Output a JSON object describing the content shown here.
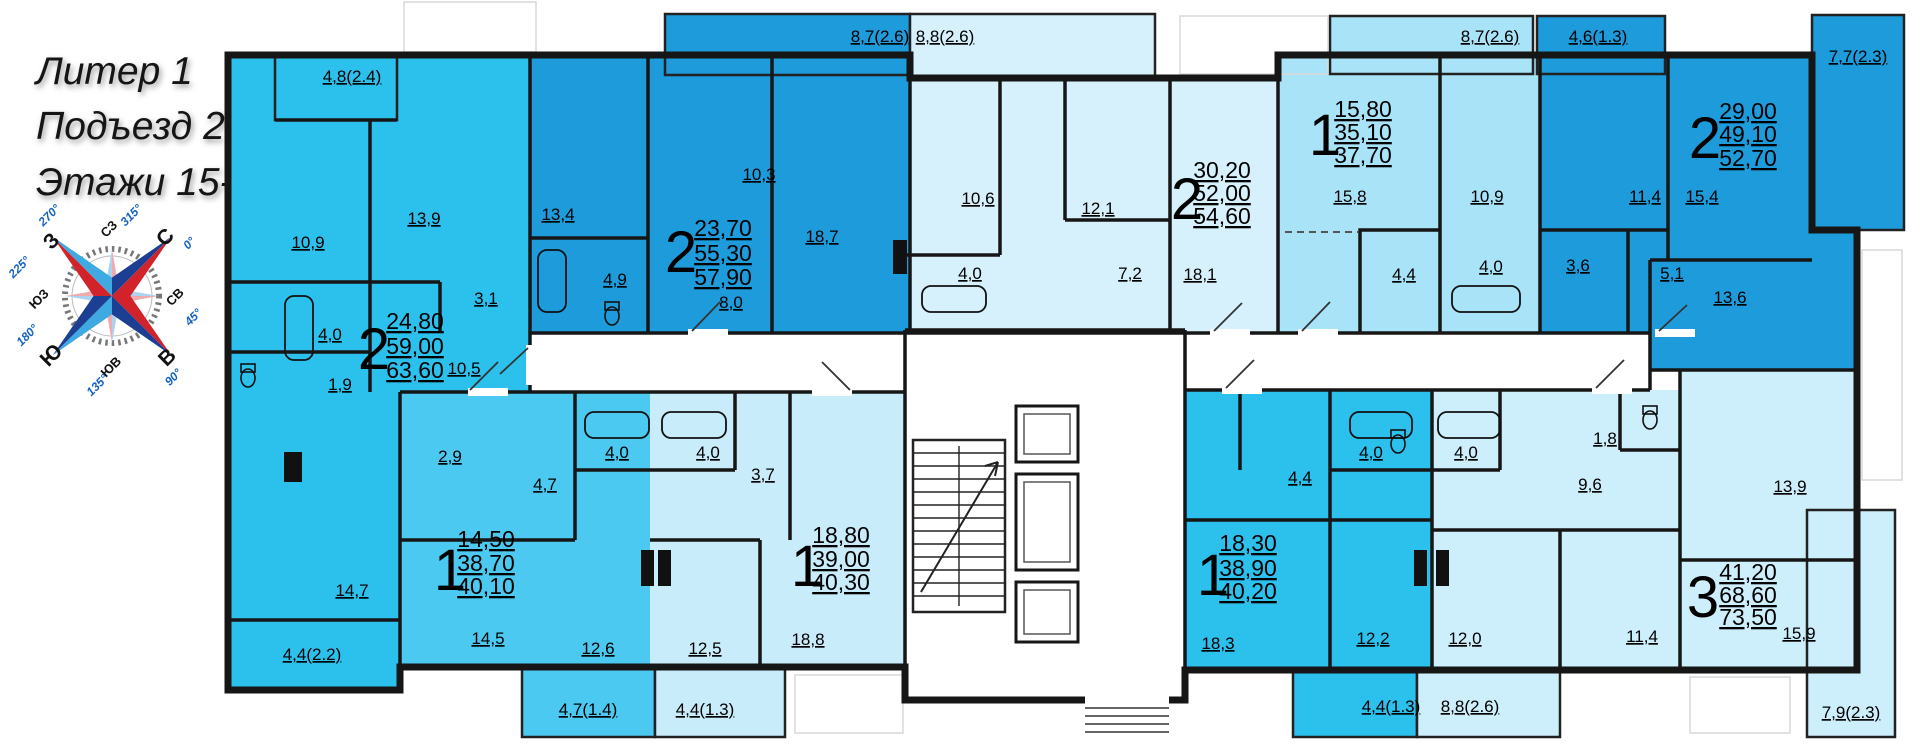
{
  "title": {
    "line1": "Литер 1",
    "line2": "Подъезд 2",
    "line3": "Этажи 15-23"
  },
  "compass": {
    "cardinals": [
      {
        "label": "С",
        "degree": "0°"
      },
      {
        "label": "СВ",
        "degree": "45°"
      },
      {
        "label": "В",
        "degree": "90°"
      },
      {
        "label": "ЮВ",
        "degree": "135°"
      },
      {
        "label": "Ю",
        "degree": "180°"
      },
      {
        "label": "ЮЗ",
        "degree": "225°"
      },
      {
        "label": "З",
        "degree": "270°"
      },
      {
        "label": "СЗ",
        "degree": "315°"
      }
    ]
  },
  "colors": {
    "wall": "#161616",
    "corridor": "#ffffff"
  },
  "apartments": [
    {
      "number_label": "2",
      "area_living": "24,80",
      "area_total": "59,00",
      "area_full": "63,60",
      "color": "#2cc0ed",
      "rooms": {
        "kitchen": "10,9",
        "bedroom": "13,9",
        "bath": "4,0",
        "wc": "1,9",
        "corridor": "3,1",
        "hall": "10,5",
        "living": "14,7"
      },
      "balconies": {
        "top": "4,8(2.4)",
        "bottom": "4,4(2.2)"
      }
    },
    {
      "number_label": "2",
      "area_living": "23,70",
      "area_total": "55,30",
      "area_full": "57,90",
      "color": "#1d9bdb",
      "rooms": {
        "bedroom1": "13,4",
        "bedroom2": "10,3",
        "kitchen_living": "18,7",
        "bath": "4,9",
        "hall": "8,0"
      },
      "balconies": {
        "top": "8,7(2.6)"
      }
    },
    {
      "number_label": "1",
      "area_living": "14,50",
      "area_total": "38,70",
      "area_full": "40,10",
      "color": "#4cc9f0",
      "rooms": {
        "corridor": "2,9",
        "hall": "4,7",
        "bath": "4,0",
        "living": "14,5",
        "kitchen": "12,6"
      },
      "balconies": {
        "bottom": "4,7(1.4)"
      }
    },
    {
      "number_label": "1",
      "area_living": "18,80",
      "area_total": "39,00",
      "area_full": "40,30",
      "color": "#c8ecfa",
      "rooms": {
        "hall": "3,7",
        "bath": "4,0",
        "bedroom": "12,5",
        "living": "18,8"
      },
      "balconies": {
        "bottom": "4,4(1.3)"
      }
    },
    {
      "number_label": "2",
      "area_living": "30,20",
      "area_total": "52,00",
      "area_full": "54,60",
      "color": "#d6f1fc",
      "rooms": {
        "kitchen": "10,6",
        "bedroom": "12,1",
        "bath": "4,0",
        "hall": "7,2",
        "living": "18,1"
      },
      "balconies": {
        "top": "8,8(2.6)"
      }
    },
    {
      "number_label": "1",
      "area_living": "15,80",
      "area_total": "35,10",
      "area_full": "37,70",
      "color": "#a9e3f7",
      "rooms": {
        "living": "15,8",
        "kitchen": "10,9",
        "hall": "4,4",
        "bath": "4,0"
      },
      "balconies": {
        "top": "8,7(2.6)"
      }
    },
    {
      "number_label": "2",
      "area_living": "29,00",
      "area_total": "49,10",
      "area_full": "52,70",
      "color": "#1d9bdb",
      "rooms": {
        "kitchen": "11,4",
        "living": "15,4",
        "bath": "3,6",
        "hall": "5,1",
        "bedroom": "13,6"
      },
      "balconies": {
        "top": "4,6(1.3)",
        "side": "7,7(2.3)"
      }
    },
    {
      "number_label": "1",
      "area_living": "18,30",
      "area_total": "38,90",
      "area_full": "40,20",
      "color": "#2cc0ed",
      "rooms": {
        "hall": "4,4",
        "bath": "4,0",
        "living": "18,3",
        "kitchen": "12,2"
      },
      "balconies": {
        "bottom": "4,4(1.3)"
      }
    },
    {
      "number_label": "3",
      "area_living": "41,20",
      "area_total": "68,60",
      "area_full": "73,50",
      "color": "#cdeefb",
      "rooms": {
        "bath": "4,0",
        "wc": "1,8",
        "hall": "9,6",
        "bedroom1": "13,9",
        "kitchen": "12,0",
        "bedroom2": "11,4",
        "living": "15,9"
      },
      "balconies": {
        "bottom": "8,8(2.6)",
        "side": "7,9(2.3)"
      }
    }
  ]
}
